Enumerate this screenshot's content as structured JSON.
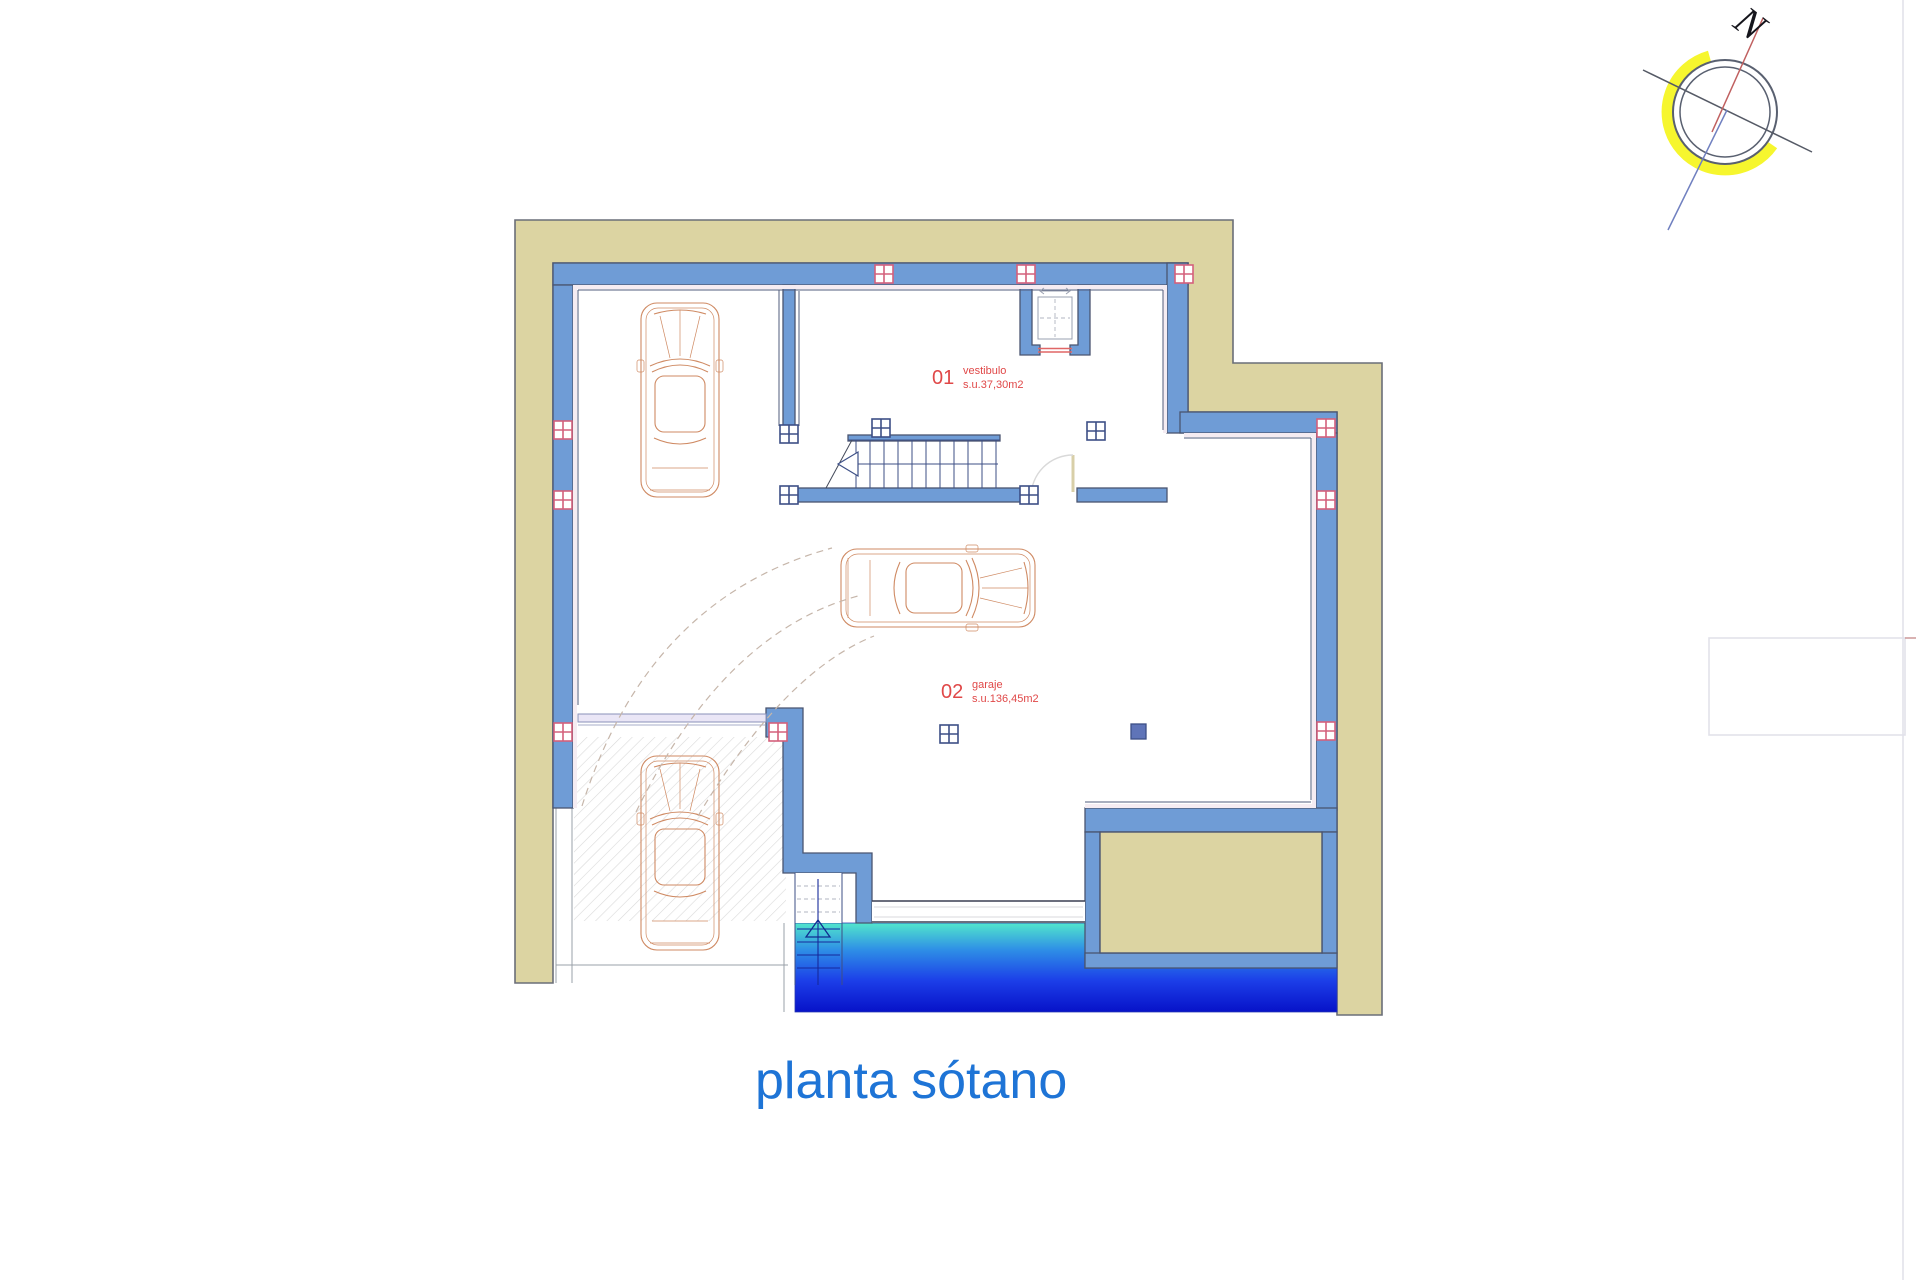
{
  "title": {
    "text": "planta sótano"
  },
  "compass": {
    "north_label": "N"
  },
  "rooms": [
    {
      "number": "01",
      "name": "vestibulo",
      "area": "s.u.37,30m2"
    },
    {
      "number": "02",
      "name": "garaje",
      "area": "s.u.136,45m2"
    }
  ],
  "colors": {
    "site_band": "#dcd4a2",
    "wall_fill": "#6f9cd6",
    "wall_line": "#4a5570",
    "pool_top": "#52e6cc",
    "pool_mid1": "#2e8fe6",
    "pool_mid2": "#1c3ee8",
    "pool_bottom": "#0712c8",
    "room_label": "#e04848",
    "title_text": "#1e74d6",
    "compass_yellow": "#f6f62e",
    "car_outline": "#cf8a63",
    "marker_pink": "#d4607c",
    "marker_blue": "#3d4f86"
  },
  "icons": {
    "compass_rose": "compass-rose",
    "car": "car-top-view",
    "interior_stair": "staircase",
    "exterior_stair": "pool-steps",
    "elevator": "elevator-shaft"
  }
}
